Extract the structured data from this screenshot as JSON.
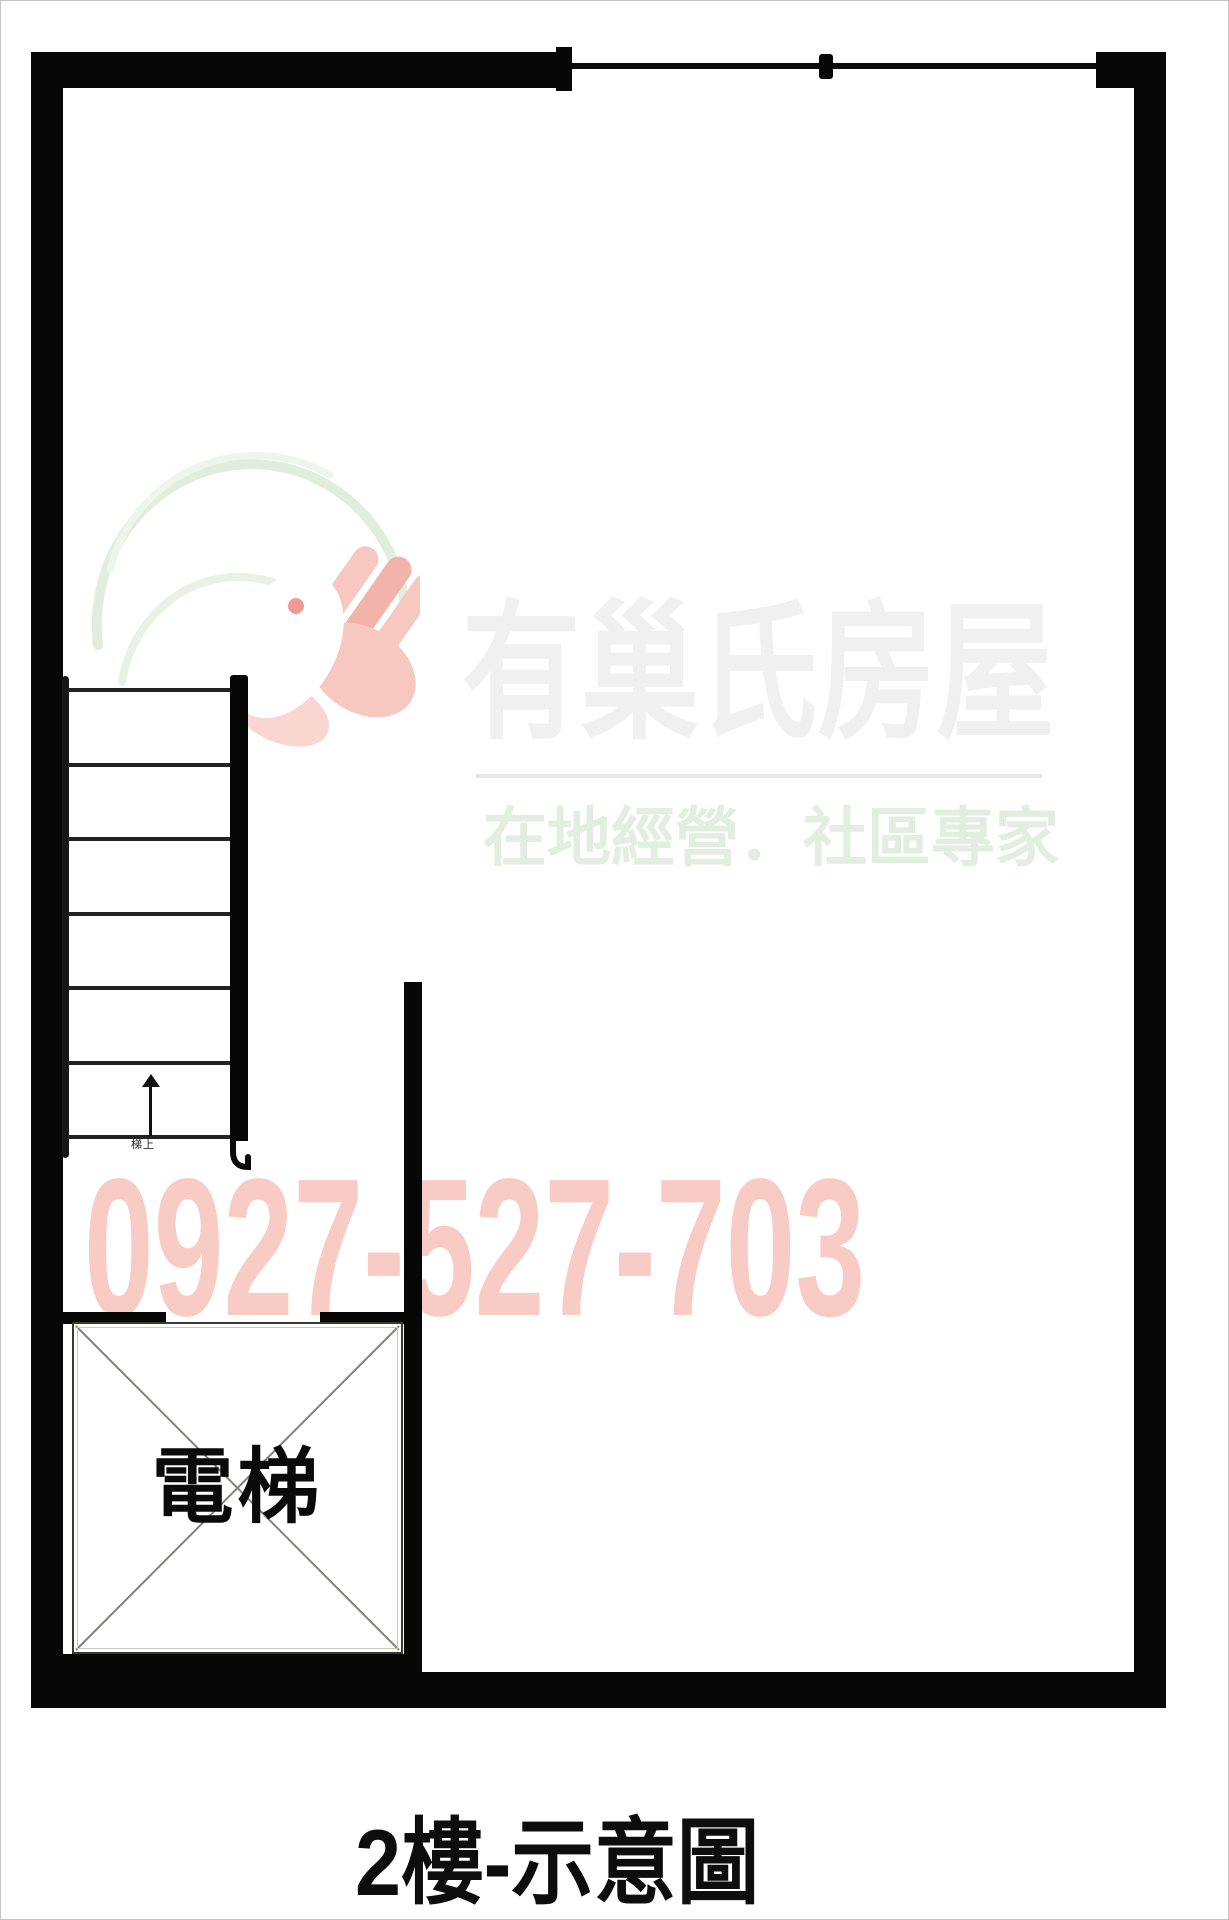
{
  "title": {
    "text": "2樓-示意圖",
    "color": "#0d0d0d"
  },
  "watermark": {
    "brand": "有巢氏房屋",
    "slogan": "在地經營．社區專家",
    "phone": "0927-527-703",
    "brand_color": "#f0f0f0",
    "slogan_color": "#e2eedf",
    "phone_color": "#f8ccc4",
    "logo": {
      "ring_color": "#e2eedd",
      "hand_color": "#f6c8c0",
      "hand_shade_color": "#f2b3aa",
      "dove_color": "#ffffff",
      "eye_color": "#ef9a94"
    }
  },
  "plan": {
    "wall_color": "#070707",
    "line_color": "#222222",
    "elevator": {
      "label": "電梯"
    },
    "stairs": {
      "tread_count": 7,
      "direction_note": "梯上",
      "arrow_direction": "up"
    },
    "window": {
      "segments": 2
    }
  }
}
